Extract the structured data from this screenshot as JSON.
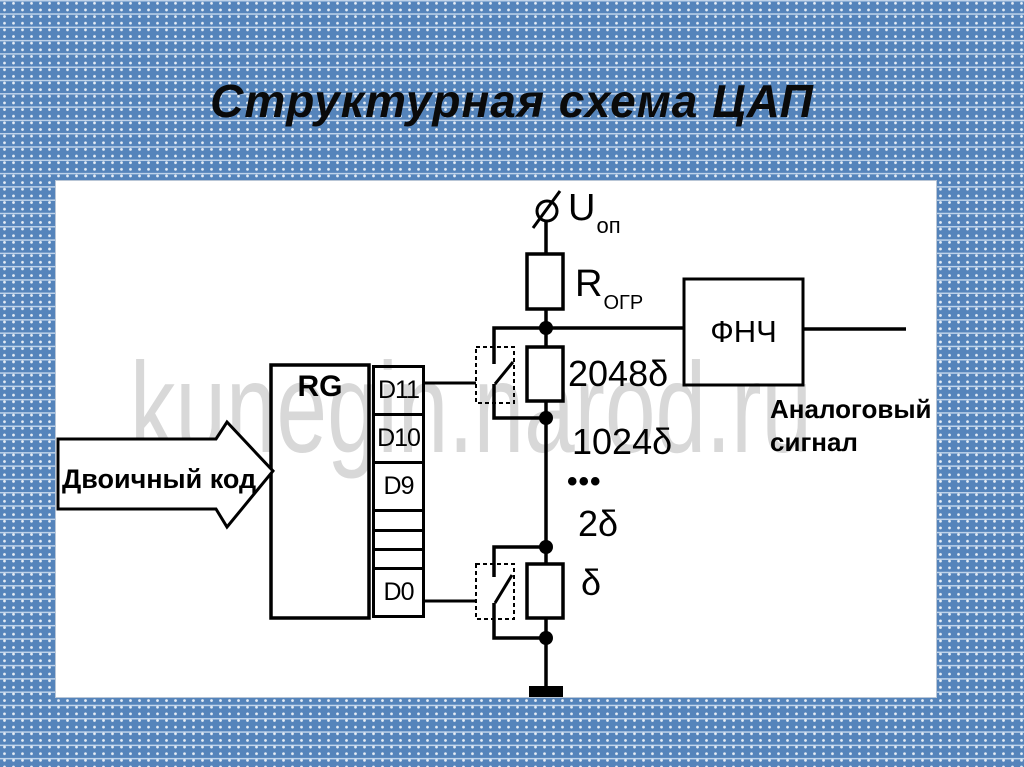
{
  "title": "Структурная схема ЦАП",
  "watermark": "kunegin.narod.ru",
  "register": {
    "label": "RG",
    "cells": [
      {
        "label": "D11"
      },
      {
        "label": "D10"
      },
      {
        "label": "D9"
      },
      {
        "label": ""
      },
      {
        "label": ""
      },
      {
        "label": ""
      },
      {
        "label": "D0"
      }
    ]
  },
  "input_arrow": {
    "label": "Двоичный код"
  },
  "reference_source": {
    "base": "U",
    "sub": "оп"
  },
  "limiting_resistor": {
    "base": "R",
    "sub": "ОГР"
  },
  "ladder_labels": {
    "r_top": "2048δ",
    "r_next": "1024δ",
    "ellipsis": "•••",
    "r_2": "2δ",
    "r_1": "δ"
  },
  "filter": {
    "label": "ФНЧ"
  },
  "output": {
    "line1": "Аналоговый",
    "line2": "сигнал"
  },
  "colors": {
    "background": "#5584bb",
    "panel": "#ffffff",
    "ink": "#000000",
    "watermark": "#d8d8d8"
  }
}
